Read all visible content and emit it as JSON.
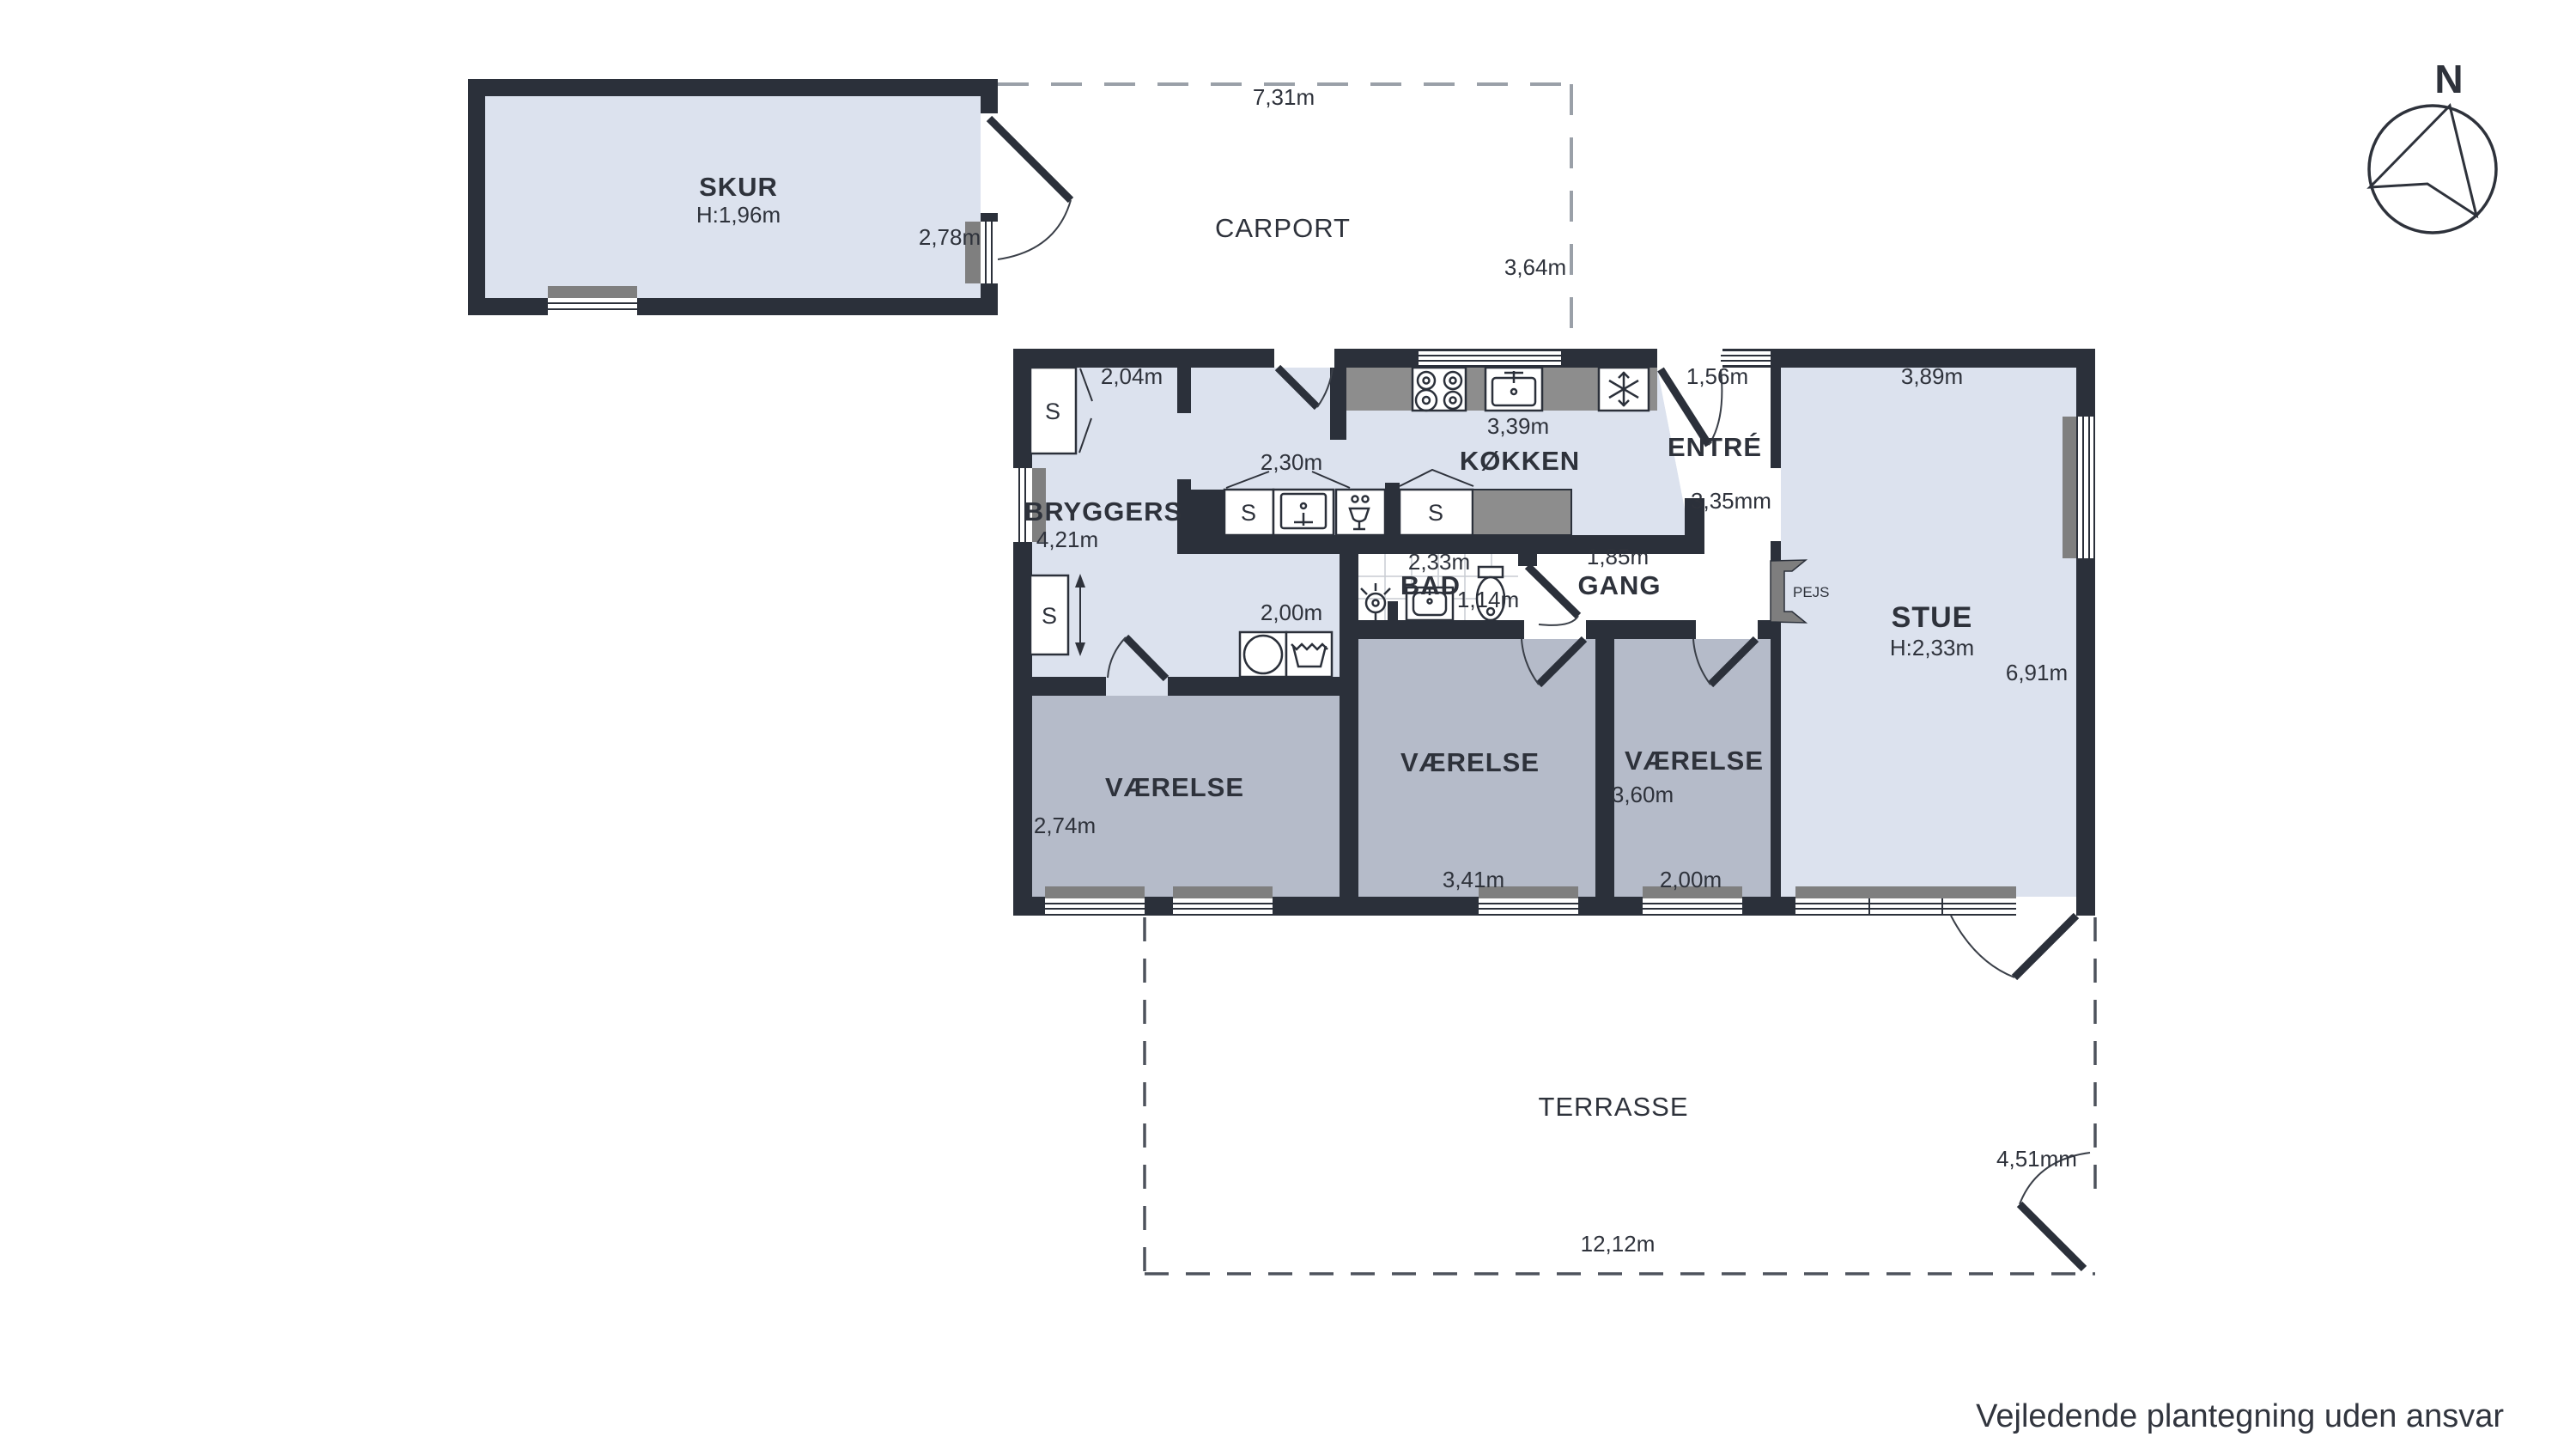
{
  "page": {
    "disclaimer": "Vejledende plantegning uden ansvar"
  },
  "compass": {
    "north_label": "N"
  },
  "colors": {
    "wall": "#2b303a",
    "floor_light": "#dce2ee",
    "floor_room_gray": "#b5bbc9",
    "floor_white": "#ffffff",
    "counter_gray": "#8d8d8d",
    "window_sill_gray": "#7f7f7f"
  },
  "labels": {
    "closet": "S",
    "skur": {
      "name": "SKUR",
      "ceiling_height": "H:1,96m",
      "width": "2,78m"
    },
    "carport": {
      "name": "CARPORT",
      "width": "7,31m",
      "depth": "3,64m"
    },
    "bryggers": {
      "name": "BRYGGERS",
      "depth": "4,21m",
      "closet_width": "2,04m",
      "island_width": "2,30m",
      "nook_width": "2,00m"
    },
    "kokken": {
      "name": "KØKKEN",
      "width": "3,39m"
    },
    "entre": {
      "name": "ENTRÉ",
      "door_width": "1,56m",
      "depth": "3,35mm"
    },
    "bad": {
      "name": "BAD",
      "width": "2,33m",
      "inner_width": "1,14m"
    },
    "gang": {
      "name": "GANG",
      "width": "1,85m"
    },
    "pejs": {
      "name": "PEJS"
    },
    "stue": {
      "name": "STUE",
      "ceiling_height": "H:2,33m",
      "width": "3,89m",
      "depth": "6,91m"
    },
    "vaerelse_left": {
      "name": "VÆRELSE",
      "width": "2,74m"
    },
    "vaerelse_mid": {
      "name": "VÆRELSE",
      "width": "3,41m"
    },
    "vaerelse_right": {
      "name": "VÆRELSE",
      "depth": "3,60m",
      "width": "2,00m"
    },
    "terrasse": {
      "name": "TERRASSE",
      "width": "12,12m",
      "depth": "4,51mm"
    }
  }
}
